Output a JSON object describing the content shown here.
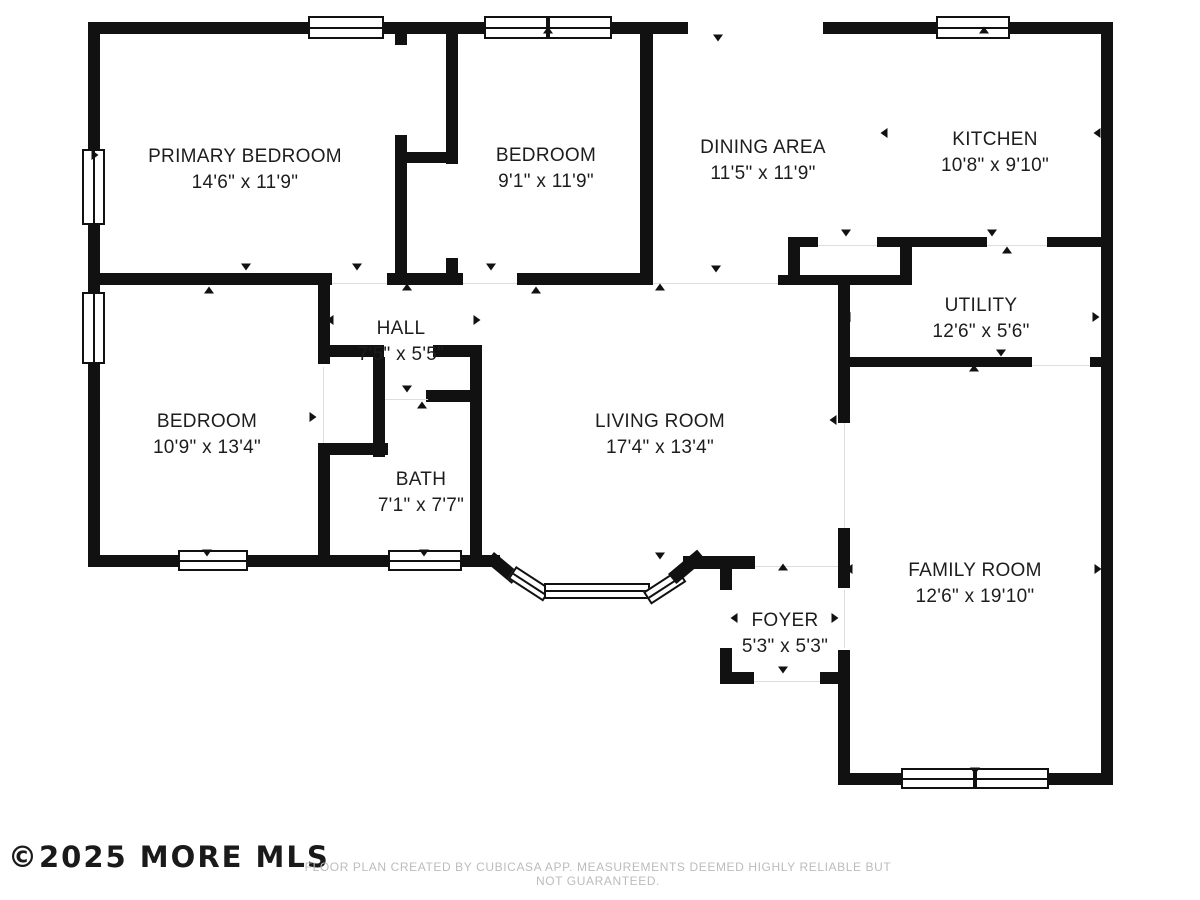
{
  "footer": {
    "copyright": "©2025 MORE MLS",
    "disclaimer": "FLOOR PLAN CREATED BY CUBICASA APP. MEASUREMENTS DEEMED HIGHLY RELIABLE BUT NOT GUARANTEED."
  },
  "plan": {
    "wall_color": "#111111",
    "background": "#ffffff",
    "rooms": [
      {
        "id": "primary-bedroom",
        "name": "PRIMARY BEDROOM",
        "dims": "14'6\" x 11'9\"",
        "cx": 245,
        "top": 144
      },
      {
        "id": "bedroom-top",
        "name": "BEDROOM",
        "dims": "9'1\" x 11'9\"",
        "cx": 546,
        "top": 143
      },
      {
        "id": "dining-area",
        "name": "DINING AREA",
        "dims": "11'5\" x 11'9\"",
        "cx": 763,
        "top": 135
      },
      {
        "id": "kitchen",
        "name": "KITCHEN",
        "dims": "10'8\" x 9'10\"",
        "cx": 995,
        "top": 127
      },
      {
        "id": "utility",
        "name": "UTILITY",
        "dims": "12'6\" x 5'6\"",
        "cx": 981,
        "top": 293
      },
      {
        "id": "hall",
        "name": "HALL",
        "dims": "7'5\" x 5'5\"",
        "cx": 401,
        "top": 316
      },
      {
        "id": "bedroom-left",
        "name": "BEDROOM",
        "dims": "10'9\" x 13'4\"",
        "cx": 207,
        "top": 409
      },
      {
        "id": "living-room",
        "name": "LIVING ROOM",
        "dims": "17'4\" x 13'4\"",
        "cx": 660,
        "top": 409
      },
      {
        "id": "bath",
        "name": "BATH",
        "dims": "7'1\" x 7'7\"",
        "cx": 421,
        "top": 467
      },
      {
        "id": "foyer",
        "name": "FOYER",
        "dims": "5'3\" x 5'3\"",
        "cx": 785,
        "top": 608
      },
      {
        "id": "family-room",
        "name": "FAMILY ROOM",
        "dims": "12'6\" x 19'10\"",
        "cx": 975,
        "top": 558
      }
    ],
    "walls": [
      [
        88,
        22,
        600,
        12
      ],
      [
        823,
        22,
        290,
        12
      ],
      [
        88,
        22,
        12,
        545
      ],
      [
        1101,
        22,
        12,
        763
      ],
      [
        88,
        555,
        412,
        12
      ],
      [
        838,
        773,
        275,
        12
      ],
      [
        640,
        22,
        13,
        263
      ],
      [
        88,
        273,
        244,
        12
      ],
      [
        387,
        273,
        76,
        12
      ],
      [
        517,
        273,
        136,
        12
      ],
      [
        778,
        275,
        134,
        10
      ],
      [
        788,
        237,
        30,
        10
      ],
      [
        877,
        237,
        110,
        10
      ],
      [
        1047,
        237,
        56,
        10
      ],
      [
        840,
        357,
        192,
        10
      ],
      [
        1090,
        357,
        13,
        10
      ],
      [
        683,
        556,
        72,
        13
      ],
      [
        720,
        672,
        34,
        12
      ],
      [
        820,
        672,
        18,
        12
      ],
      [
        400,
        152,
        58,
        11
      ],
      [
        395,
        34,
        12,
        11
      ],
      [
        395,
        135,
        12,
        150
      ],
      [
        446,
        34,
        12,
        130
      ],
      [
        446,
        258,
        12,
        27
      ],
      [
        788,
        237,
        12,
        48
      ],
      [
        900,
        237,
        12,
        48
      ],
      [
        838,
        285,
        12,
        138
      ],
      [
        838,
        528,
        12,
        60
      ],
      [
        838,
        650,
        12,
        135
      ],
      [
        720,
        568,
        12,
        22
      ],
      [
        720,
        648,
        12,
        36
      ],
      [
        318,
        285,
        12,
        60
      ],
      [
        318,
        343,
        12,
        21
      ],
      [
        318,
        345,
        66,
        12
      ],
      [
        433,
        345,
        49,
        12
      ],
      [
        373,
        357,
        12,
        100
      ],
      [
        318,
        443,
        70,
        12
      ],
      [
        318,
        443,
        12,
        124
      ],
      [
        426,
        390,
        56,
        12
      ],
      [
        470,
        345,
        12,
        222
      ]
    ],
    "bay": [
      {
        "x": 494,
        "y": 552,
        "w": 34,
        "h": 13,
        "deg": 40,
        "type": "wall"
      },
      {
        "x": 516,
        "y": 566,
        "w": 42,
        "h": 15,
        "deg": 33,
        "type": "window"
      },
      {
        "x": 544,
        "y": 583,
        "w": 106,
        "h": 16,
        "deg": 0,
        "type": "window"
      },
      {
        "x": 643,
        "y": 592,
        "w": 42,
        "h": 15,
        "deg": -33,
        "type": "window"
      },
      {
        "x": 668,
        "y": 574,
        "w": 38,
        "h": 13,
        "deg": -40,
        "type": "wall"
      }
    ],
    "windows": [
      {
        "x": 308,
        "y": 16,
        "w": 76,
        "h": 23,
        "o": "h",
        "double": false
      },
      {
        "x": 484,
        "y": 16,
        "w": 128,
        "h": 23,
        "o": "h",
        "double": true
      },
      {
        "x": 936,
        "y": 16,
        "w": 74,
        "h": 23,
        "o": "h",
        "double": false
      },
      {
        "x": 82,
        "y": 149,
        "w": 23,
        "h": 76,
        "o": "v",
        "double": false
      },
      {
        "x": 82,
        "y": 292,
        "w": 23,
        "h": 72,
        "o": "v",
        "double": false
      },
      {
        "x": 178,
        "y": 550,
        "w": 70,
        "h": 21,
        "o": "h",
        "double": false
      },
      {
        "x": 388,
        "y": 550,
        "w": 74,
        "h": 21,
        "o": "h",
        "double": false
      },
      {
        "x": 901,
        "y": 768,
        "w": 148,
        "h": 21,
        "o": "h",
        "double": true
      }
    ],
    "opening_lines": [
      [
        332,
        283,
        55,
        1
      ],
      [
        463,
        283,
        54,
        1
      ],
      [
        653,
        283,
        125,
        1
      ],
      [
        818,
        245,
        59,
        1
      ],
      [
        987,
        245,
        60,
        1
      ],
      [
        1032,
        365,
        58,
        1
      ],
      [
        844,
        423,
        1,
        105
      ],
      [
        755,
        566,
        83,
        1
      ],
      [
        754,
        681,
        66,
        1
      ],
      [
        844,
        590,
        1,
        58
      ],
      [
        323,
        367,
        1,
        76
      ],
      [
        385,
        399,
        43,
        1
      ]
    ],
    "arrows": [
      [
        244,
        30,
        "up"
      ],
      [
        548,
        30,
        "up"
      ],
      [
        718,
        38,
        "down"
      ],
      [
        984,
        30,
        "up"
      ],
      [
        95,
        155,
        "right"
      ],
      [
        95,
        418,
        "left"
      ],
      [
        246,
        267,
        "down"
      ],
      [
        209,
        290,
        "up"
      ],
      [
        357,
        267,
        "down"
      ],
      [
        407,
        287,
        "up"
      ],
      [
        491,
        267,
        "down"
      ],
      [
        536,
        290,
        "up"
      ],
      [
        660,
        287,
        "up"
      ],
      [
        716,
        269,
        "down"
      ],
      [
        884,
        133,
        "left"
      ],
      [
        1097,
        133,
        "left"
      ],
      [
        992,
        233,
        "down"
      ],
      [
        1007,
        250,
        "up"
      ],
      [
        846,
        233,
        "down"
      ],
      [
        847,
        317,
        "left"
      ],
      [
        1096,
        317,
        "right"
      ],
      [
        1001,
        353,
        "down"
      ],
      [
        974,
        368,
        "up"
      ],
      [
        330,
        320,
        "left"
      ],
      [
        477,
        320,
        "right"
      ],
      [
        407,
        389,
        "down"
      ],
      [
        422,
        405,
        "up"
      ],
      [
        313,
        417,
        "right"
      ],
      [
        833,
        420,
        "left"
      ],
      [
        207,
        553,
        "down"
      ],
      [
        424,
        553,
        "down"
      ],
      [
        660,
        556,
        "down"
      ],
      [
        783,
        567,
        "up"
      ],
      [
        734,
        618,
        "left"
      ],
      [
        835,
        618,
        "right"
      ],
      [
        783,
        670,
        "down"
      ],
      [
        849,
        569,
        "left"
      ],
      [
        1098,
        569,
        "right"
      ],
      [
        975,
        771,
        "down"
      ]
    ]
  }
}
